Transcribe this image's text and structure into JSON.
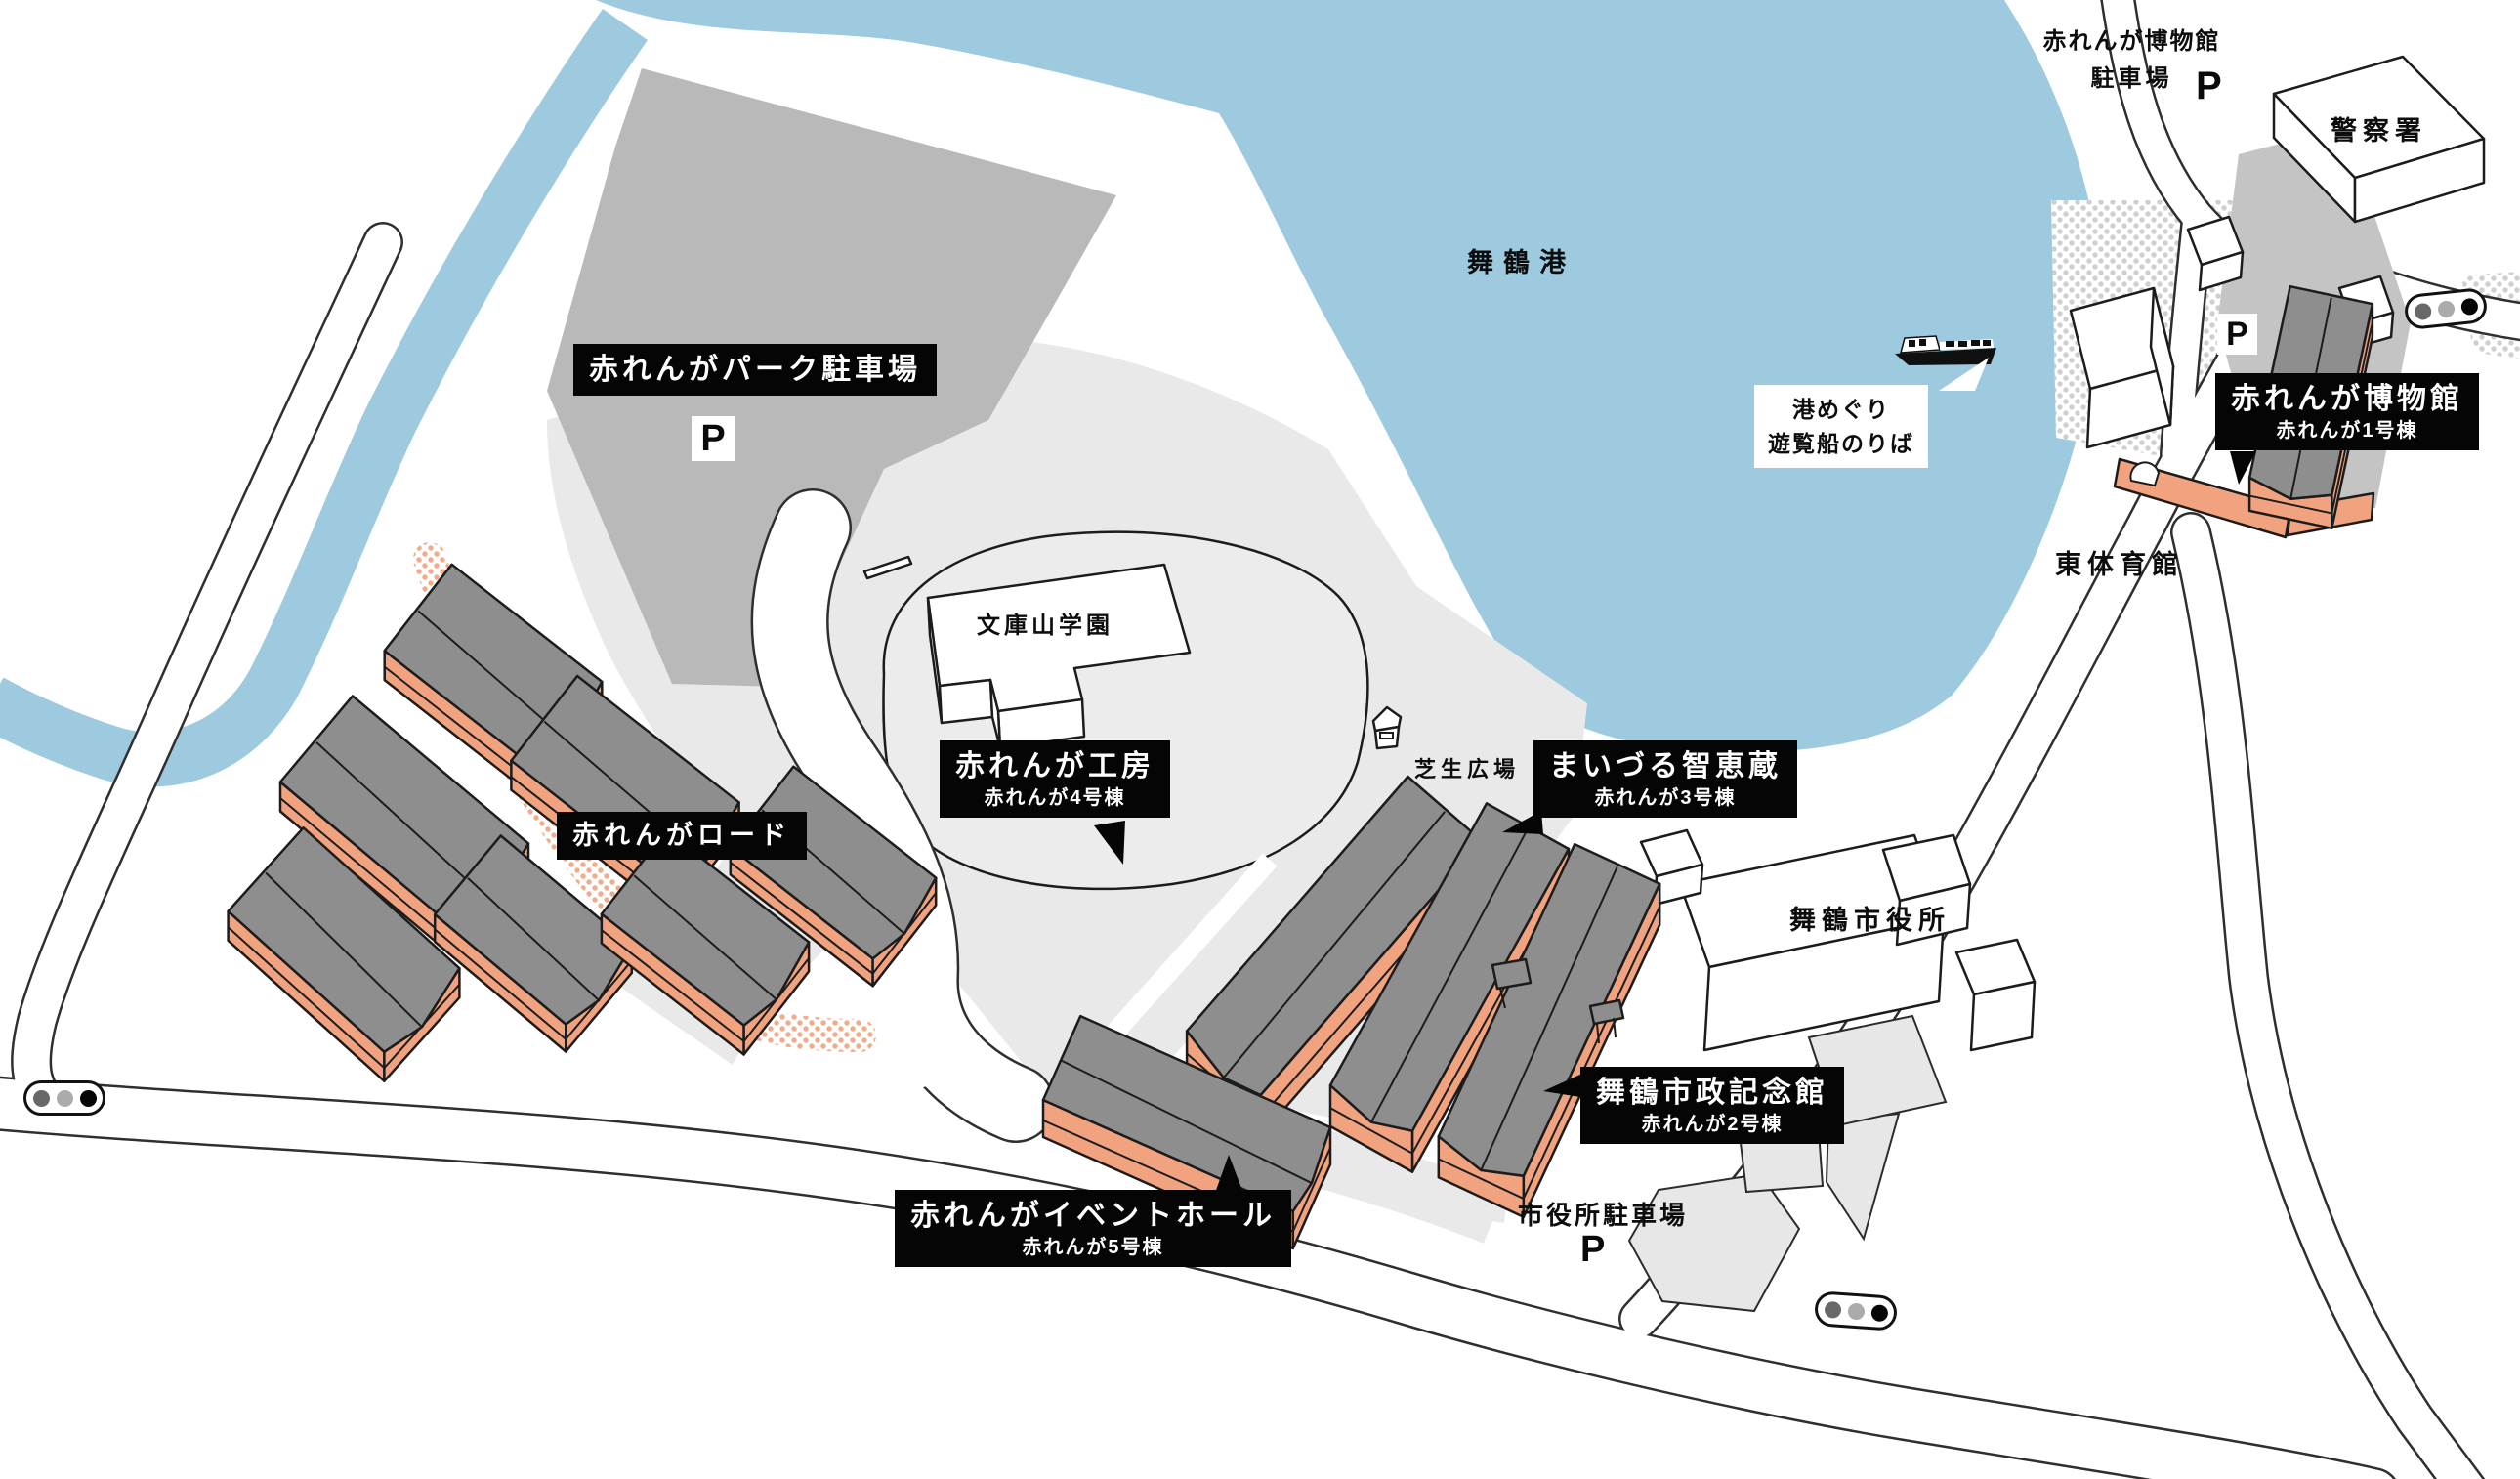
{
  "sea_label": "舞鶴港",
  "black_labels": {
    "park_parking": {
      "title": "赤れんがパーク駐車場"
    },
    "brick_road": {
      "title": "赤れんがロード"
    },
    "workshop": {
      "title": "赤れんが工房",
      "subtitle": "赤れんが4号棟"
    },
    "chiekura": {
      "title": "まいづる智恵蔵",
      "subtitle": "赤れんが3号棟"
    },
    "memorial": {
      "title": "舞鶴市政記念館",
      "subtitle": "赤れんが2号棟"
    },
    "event_hall": {
      "title": "赤れんがイベントホール",
      "subtitle": "赤れんが5号棟"
    },
    "museum": {
      "title": "赤れんが博物館",
      "subtitle": "赤れんが1号棟"
    }
  },
  "plain_labels": {
    "police": "警察署",
    "museum_parking_line1": "赤れんが博物館",
    "museum_parking_line2": "駐車場",
    "gym": "東体育館",
    "school": "文庫山学園",
    "lawn": "芝生広場",
    "city_hall": "舞鶴市役所",
    "city_hall_parking": "市役所駐車場"
  },
  "bubble": {
    "line1": "港めぐり",
    "line2": "遊覧船のりば"
  },
  "parking_mark": "P",
  "colors": {
    "water": "#9dcade",
    "parking_lot_dark": "#b9b9b9",
    "ground_light": "#e9e9e9",
    "brick_orange": "#f1a37f",
    "roof_gray": "#8e8e8e",
    "label_background": "#050505",
    "road_dot_orange": "#f3aa89"
  }
}
